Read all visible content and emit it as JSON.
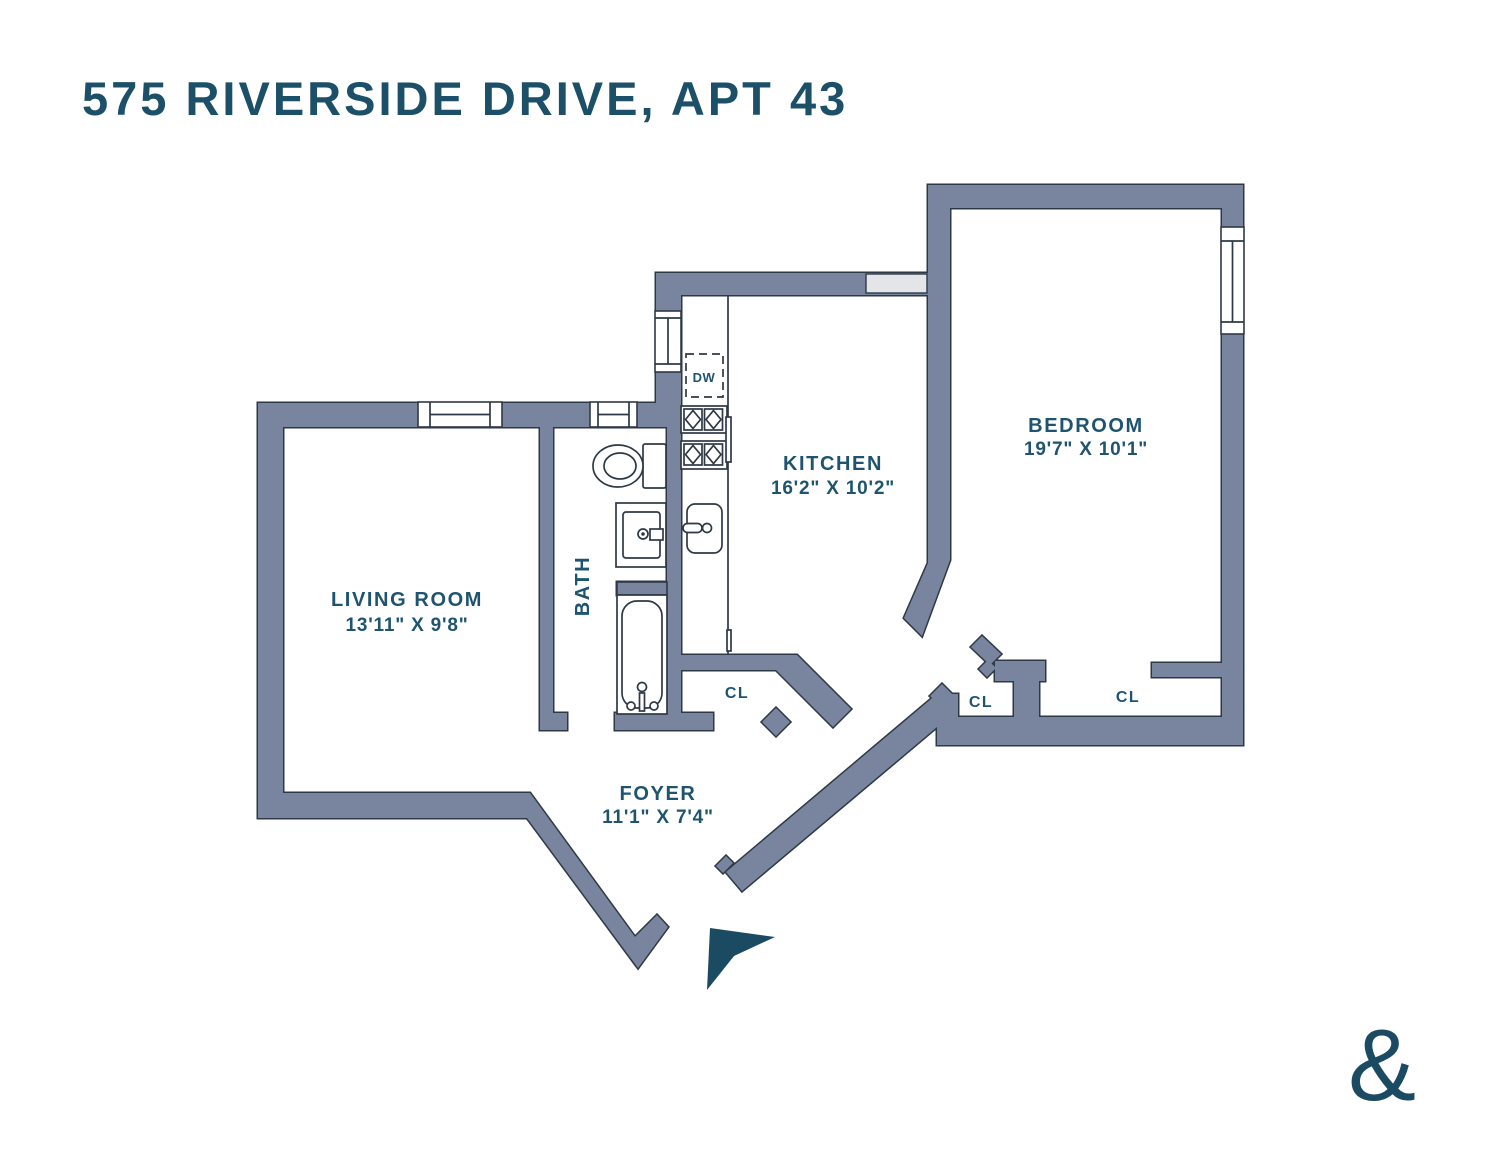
{
  "title": "575 RIVERSIDE DRIVE, APT 43",
  "colors": {
    "wall_fill": "#79859E",
    "wall_outline": "#2E3946",
    "accent_text": "#1E5470",
    "title_text": "#1C5068",
    "window_gray": "#E3E5E9",
    "logo_teal": "#1B4B62"
  },
  "rooms": {
    "living_room": {
      "name": "LIVING ROOM",
      "dims": "13'11\" X 9'8\""
    },
    "kitchen": {
      "name": "KITCHEN",
      "dims": "16'2\" X 10'2\""
    },
    "bedroom": {
      "name": "BEDROOM",
      "dims": "19'7\" X 10'1\""
    },
    "foyer": {
      "name": "FOYER",
      "dims": "11'1\" X 7'4\""
    },
    "bath": {
      "name": "BATH"
    }
  },
  "labels": {
    "closet": "CL",
    "dishwasher": "DW"
  },
  "logo": {
    "glyph": "&"
  }
}
